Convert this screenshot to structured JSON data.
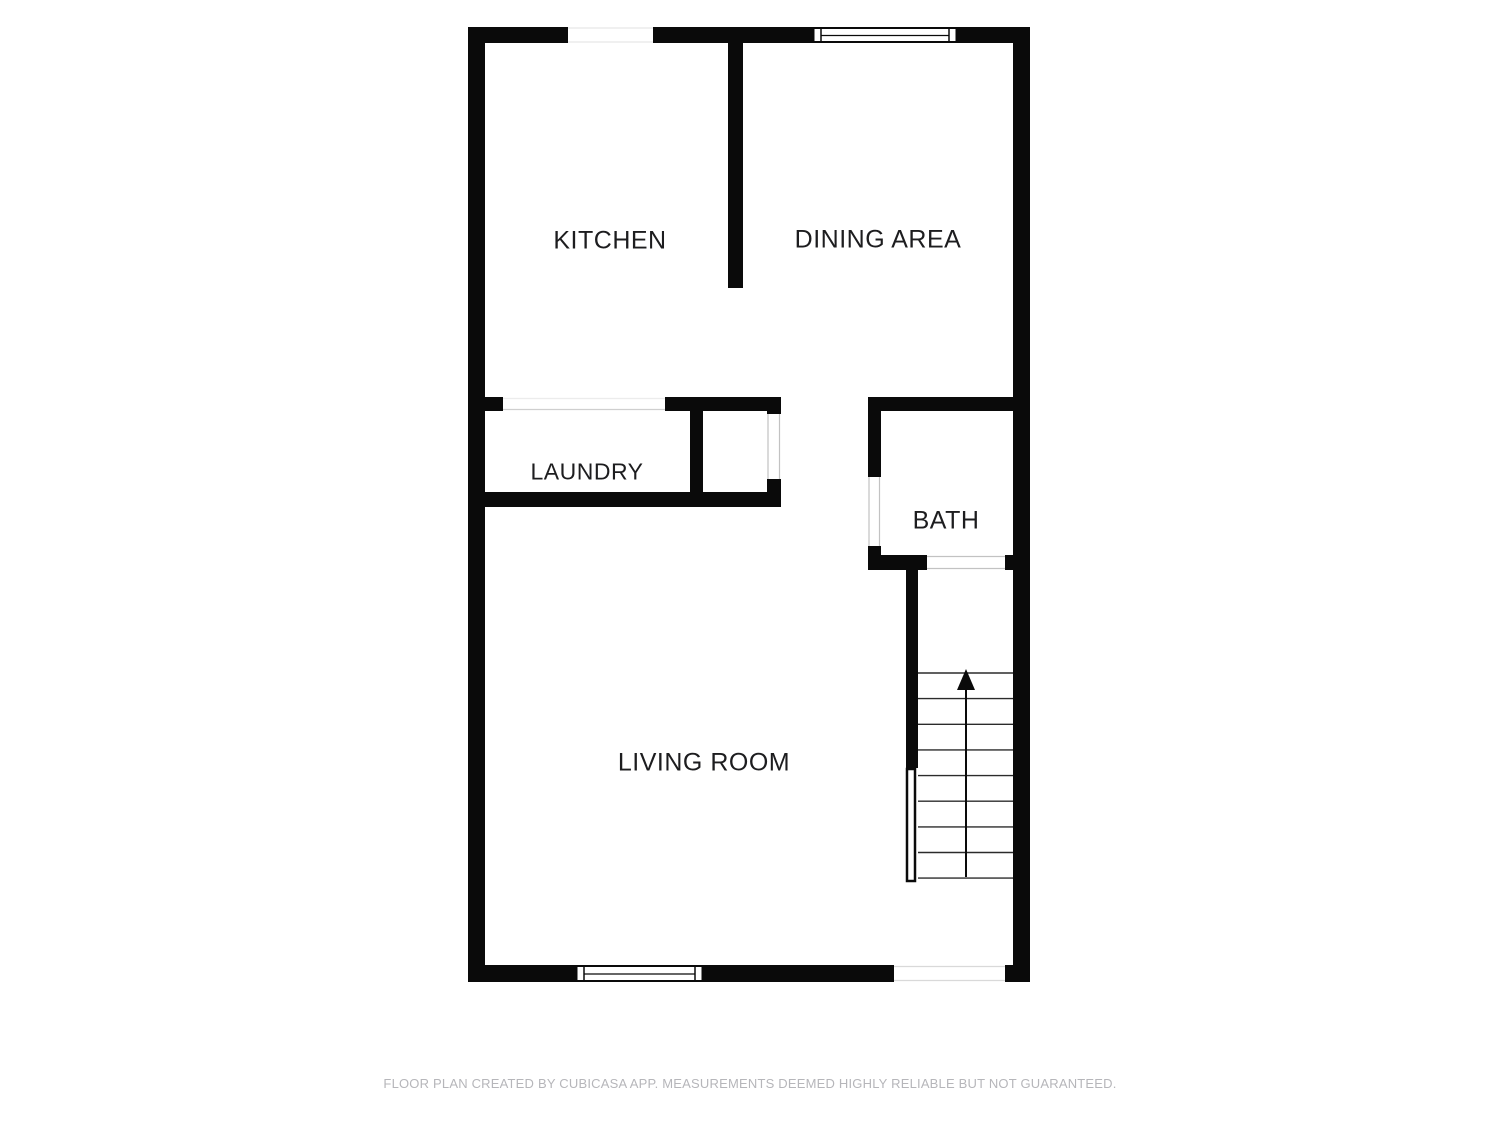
{
  "page": {
    "background": "#ffffff"
  },
  "colors": {
    "wall": "#0a0a0a",
    "room_label": "#1d1d1f",
    "footer_text": "#b6b6ba",
    "opening_line": "#c2c2c2"
  },
  "plan": {
    "rooms": [
      {
        "label": "KITCHEN"
      },
      {
        "label": "DINING AREA"
      },
      {
        "label": "LAUNDRY"
      },
      {
        "label": "BATH"
      },
      {
        "label": "LIVING ROOM"
      }
    ],
    "stairs": {
      "steps": 8,
      "direction": "up"
    }
  },
  "footer": {
    "text": "FLOOR PLAN CREATED BY CUBICASA APP. MEASUREMENTS DEEMED HIGHLY RELIABLE BUT NOT GUARANTEED."
  }
}
